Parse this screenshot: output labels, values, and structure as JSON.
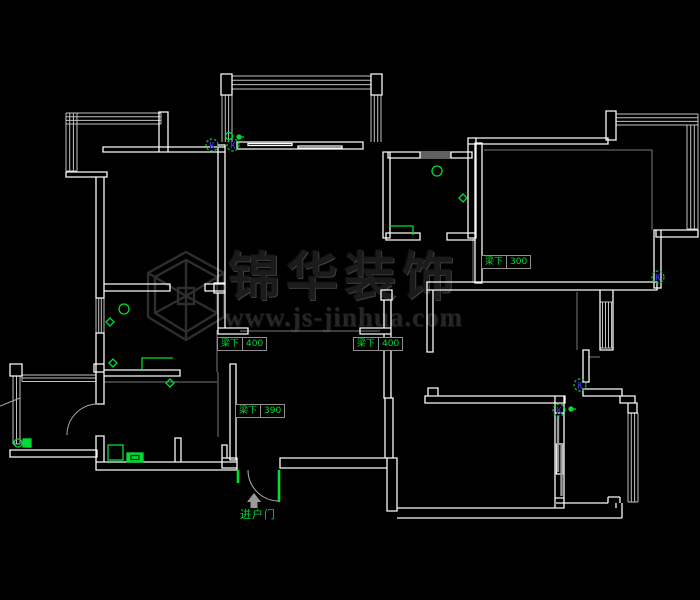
{
  "canvas": {
    "width": 700,
    "height": 600,
    "background": "#000000"
  },
  "colors": {
    "wall": "#fafafa",
    "window_line": "#c2c2c2",
    "aux_line": "#7a7a7a",
    "door_line": "#a8a8a8",
    "annotation_green": "#00dd33",
    "k_letter_blue": "#2d2dd0",
    "label_border_gray": "#8f8f8f",
    "watermark_gray": "#2b2b2b"
  },
  "watermark": {
    "logo_icon": "hexagon-cube-logo",
    "brand": "锦华装饰",
    "url": "www.js-jinhua.com"
  },
  "beam_labels": [
    {
      "prefix": "梁下",
      "value": "300",
      "x": 481,
      "y": 255
    },
    {
      "prefix": "梁下",
      "value": "400",
      "x": 217,
      "y": 337
    },
    {
      "prefix": "梁下",
      "value": "400",
      "x": 353,
      "y": 337
    },
    {
      "prefix": "梁下",
      "value": "390",
      "x": 235,
      "y": 404
    }
  ],
  "entry": {
    "label": "进户门",
    "arrow_icon": "up-arrow-icon"
  },
  "symbols": {
    "k_label": "K",
    "k_positions": [
      {
        "x": 212,
        "y": 145
      },
      {
        "x": 233,
        "y": 145
      },
      {
        "x": 658,
        "y": 277
      },
      {
        "x": 580,
        "y": 385
      },
      {
        "x": 559,
        "y": 410
      }
    ]
  }
}
